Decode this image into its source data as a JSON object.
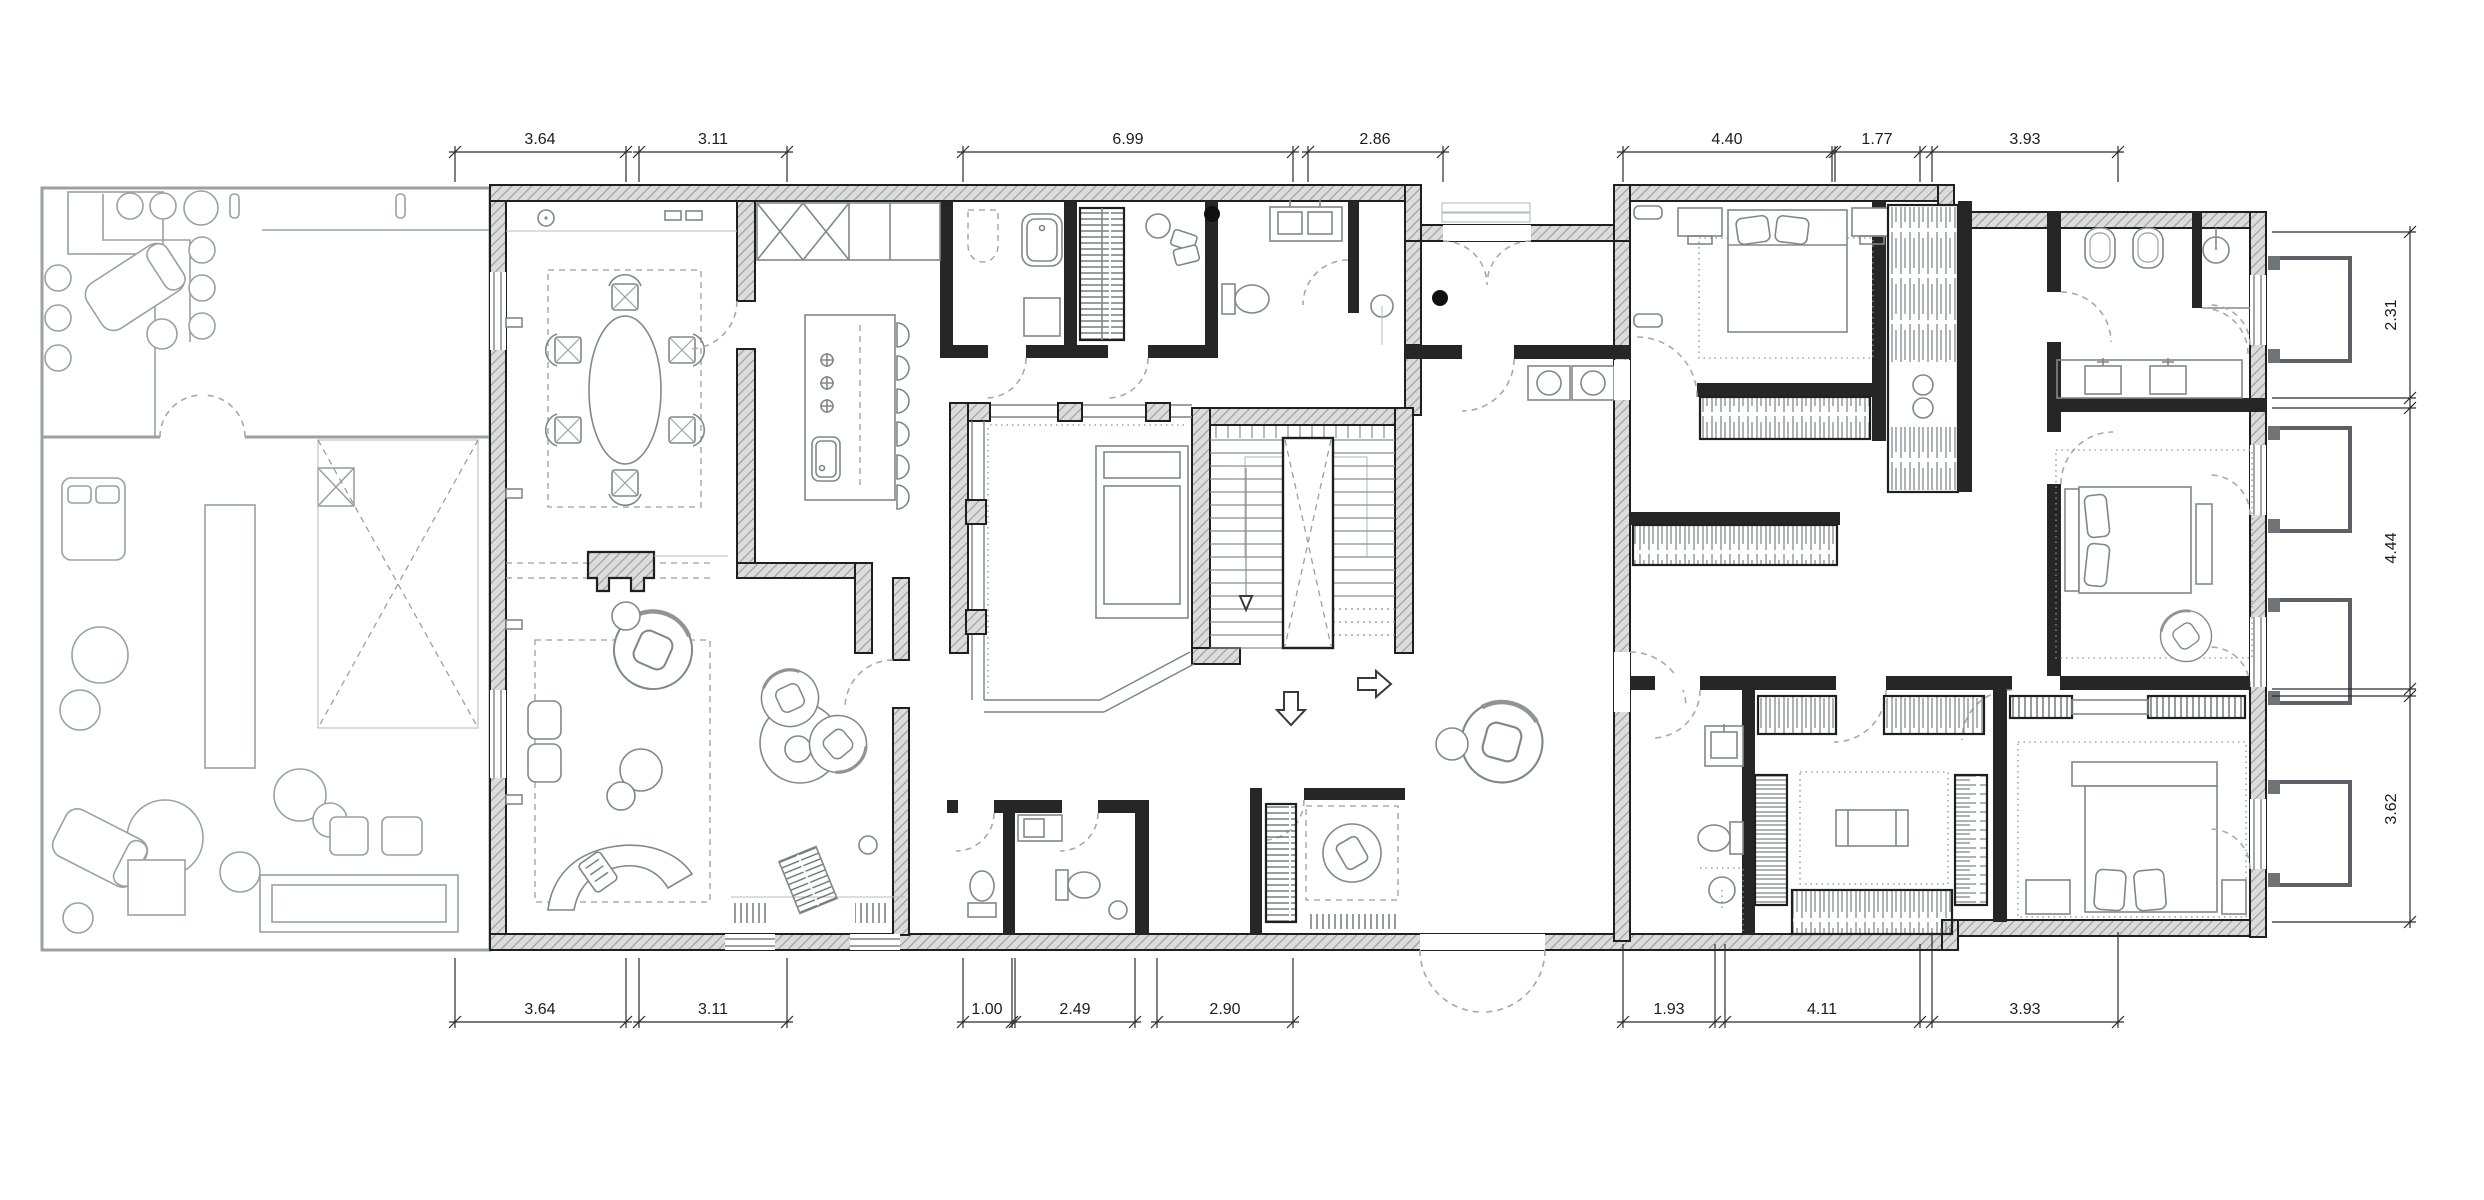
{
  "plan": {
    "type": "architectural-floor-plan",
    "dimensions": {
      "top": [
        "3.64",
        "3.11",
        "6.99",
        "2.86",
        "4.40",
        "1.77",
        "3.93"
      ],
      "bottom": [
        "3.64",
        "3.11",
        "1.00",
        "2.49",
        "2.90",
        "1.93",
        "4.11",
        "3.93"
      ],
      "right": [
        "2.31",
        "4.44",
        "3.62"
      ]
    },
    "colors": {
      "ink": "#1f1f1f",
      "wall_hatch_bg": "#dcdcdc",
      "wall_hatch_line": "#9b9b9b",
      "partition": "#262626",
      "furniture_line": "#82878b",
      "annex_line": "#9aa0a4",
      "door_arc": "#a9a9a9",
      "dim_line": "#2b2b2b"
    }
  }
}
